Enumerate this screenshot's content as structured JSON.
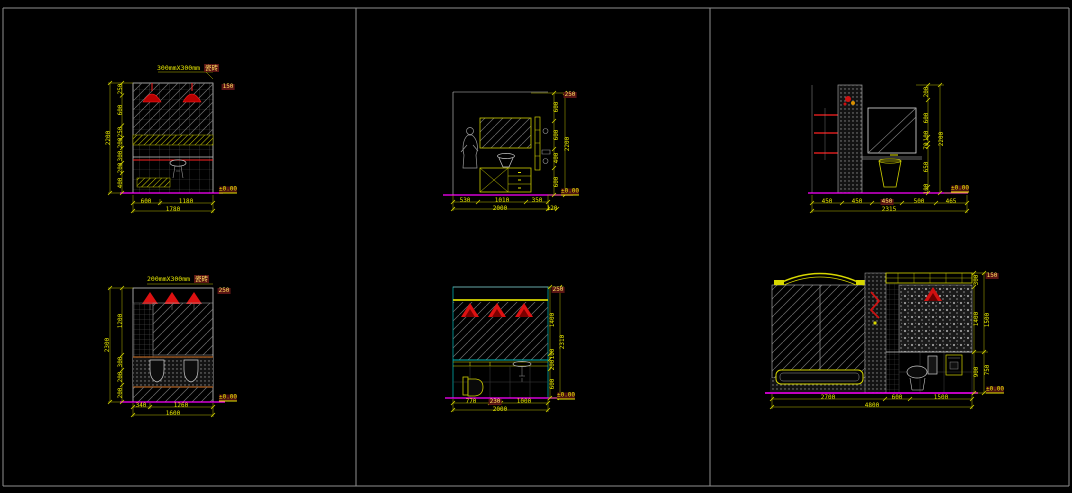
{
  "app": {
    "background": "#000000",
    "frame_color": "#8f8f8f"
  },
  "colors": {
    "dimension": "#e8e800",
    "drawing_line": "#d0d0d0",
    "lamp_red": "#dd1111",
    "floor_line": "#ff00ff",
    "counter_cyan": "#00a8a8",
    "band_brown": "#b06020"
  },
  "panels": {
    "p1": {
      "title_size": "300mmX300mm",
      "title_word": "瓷砖",
      "left": [
        "250",
        "600",
        "250",
        "200",
        "300",
        "200",
        "400"
      ],
      "left_total": "2200",
      "bottom": [
        "600",
        "1180"
      ],
      "bottom_total": "1780",
      "note_top": "150",
      "level": "±0.00"
    },
    "p2": {
      "right": [
        "600",
        "600",
        "400",
        "600"
      ],
      "right_total": "2200",
      "bottom": [
        "530",
        "1010",
        "350"
      ],
      "bottom_total": "2000",
      "bottom_extra": "120",
      "note_top": "250",
      "level": "±0.00"
    },
    "p3": {
      "right": [
        "200",
        "600",
        "100",
        "70",
        "650",
        "100"
      ],
      "right_total": "2200",
      "bottom": [
        "450",
        "450",
        "450",
        "500",
        "465"
      ],
      "bottom_total": "2315",
      "level": "±0.00"
    },
    "p4": {
      "title_size": "200mmX300mm",
      "title_word": "瓷砖",
      "left": [
        "1200",
        "300",
        "200",
        "200"
      ],
      "left_total": "2300",
      "bottom": [
        "340",
        "1260"
      ],
      "bottom_total": "1600",
      "note_top": "250",
      "level": "±0.00"
    },
    "p5": {
      "right": [
        "1400",
        "100",
        "200",
        "600"
      ],
      "right_total": "2310",
      "bottom": [
        "770",
        "230",
        "1000"
      ],
      "bottom_total": "2000",
      "note_top": "250",
      "level": "±0.00"
    },
    "p6": {
      "right": [
        "300",
        "1400",
        "900"
      ],
      "right_outer": [
        "1500",
        "750"
      ],
      "bottom": [
        "2700",
        "600",
        "1500"
      ],
      "bottom_total": "4800",
      "note_top": "150",
      "level": "±0.00"
    }
  }
}
